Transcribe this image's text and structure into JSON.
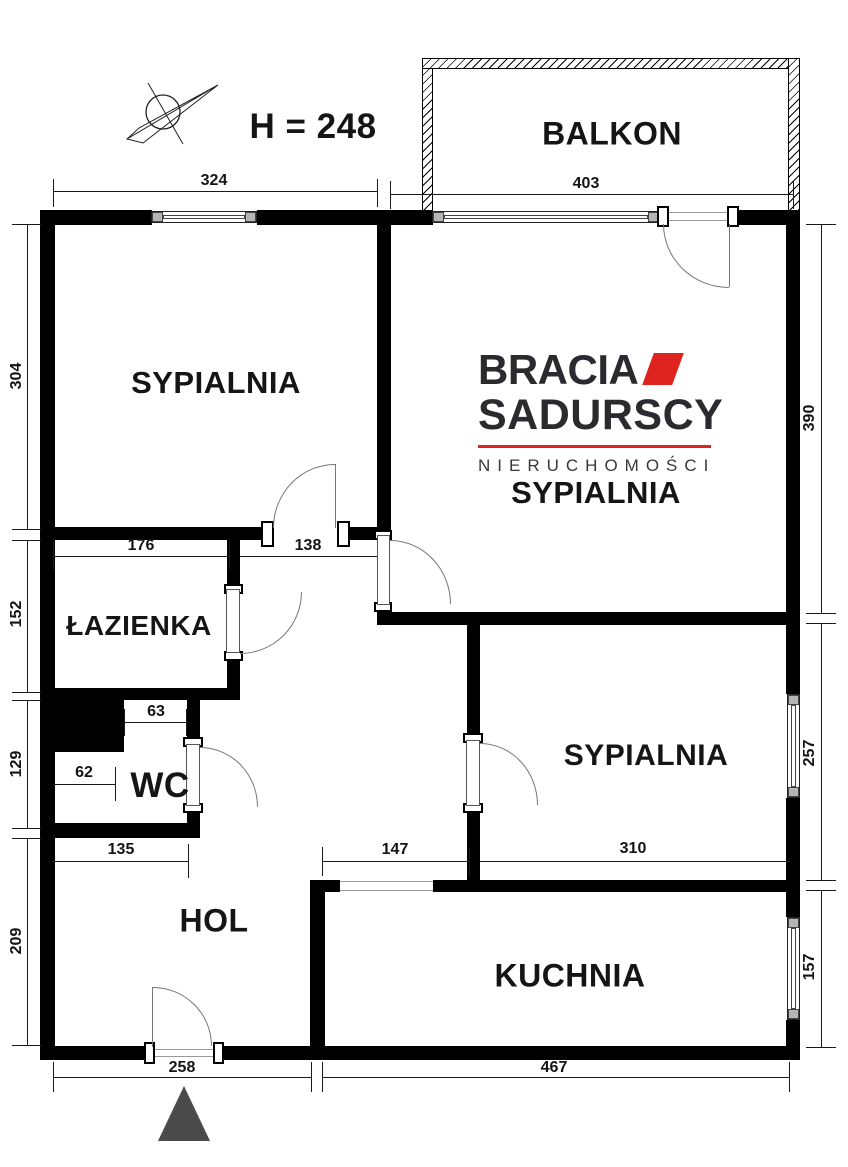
{
  "header": {
    "height_label": "H = 248"
  },
  "logo": {
    "brand_line1": "BRACIA",
    "brand_line2": "SADURSCY",
    "tagline": "NIERUCHOMOŚCI",
    "accent_color": "#df2420"
  },
  "rooms": {
    "balcony": "BALKON",
    "bedroom1": "SYPIALNIA",
    "bedroom2": "SYPIALNIA",
    "bedroom3": "SYPIALNIA",
    "bathroom": "ŁAZIENKA",
    "wc": "WC",
    "hall": "HOL",
    "kitchen": "KUCHNIA"
  },
  "dims": {
    "top_left": "324",
    "balcony_w": "403",
    "bedroom1_h": "304",
    "bathroom_h": "152",
    "wc_h": "129",
    "hall_h": "209",
    "bedroom2_h": "390",
    "bedroom3_h": "257",
    "kitchen_h": "157",
    "bathroom_w": "176",
    "corridor_w": "138",
    "wc_top_w": "63",
    "wc_w": "62",
    "hall_w": "135",
    "passage_w": "147",
    "bedroom3_w": "310",
    "entry_w": "258",
    "kitchen_w": "467"
  }
}
